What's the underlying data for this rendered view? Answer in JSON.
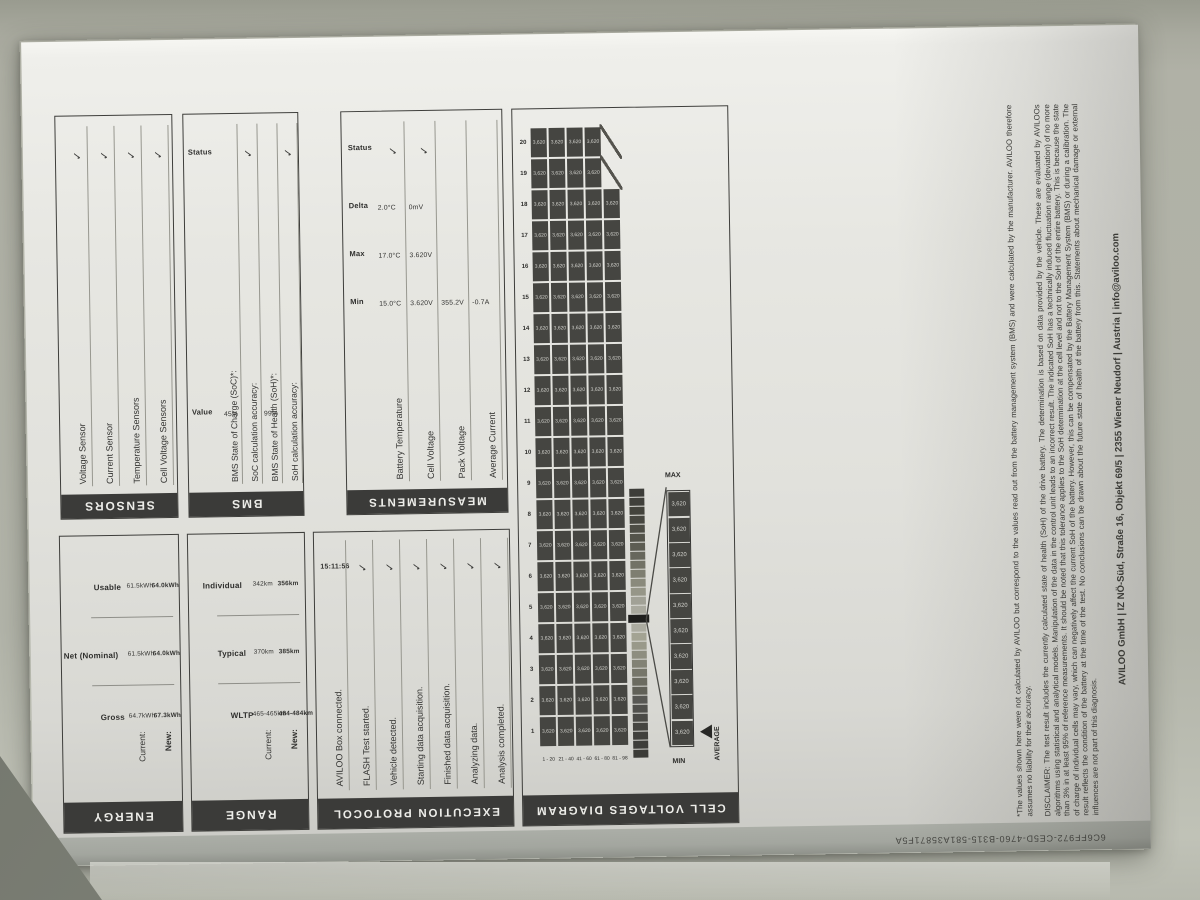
{
  "report": {
    "sections": {
      "sensors": {
        "title": "SENSORS",
        "rows": [
          {
            "label": "Voltage Sensor",
            "status": "✓"
          },
          {
            "label": "Current Sensor",
            "status": "✓"
          },
          {
            "label": "Temperature Sensors",
            "status": "✓"
          },
          {
            "label": "Cell Voltage Sensors",
            "status": "✓"
          }
        ]
      },
      "bms": {
        "title": "BMS",
        "headers": {
          "value": "Value",
          "status": "Status"
        },
        "rows": [
          {
            "label": "BMS State of Charge (SoC)*:",
            "value": "45%",
            "status": ""
          },
          {
            "label": "SoC calculation accuracy:",
            "value": "",
            "status": "✓"
          },
          {
            "label": "BMS State of Health (SoH)*:",
            "value": "99%",
            "status": ""
          },
          {
            "label": "SoH calculation accuracy:",
            "value": "",
            "status": "✓"
          }
        ]
      },
      "measurements": {
        "title": "MEASUREMENTS",
        "headers": {
          "min": "Min",
          "max": "Max",
          "delta": "Delta",
          "status": "Status"
        },
        "rows": [
          {
            "label": "Battery Temperature",
            "min": "15.0°C",
            "max": "17.0°C",
            "delta": "2.0°C",
            "status": "✓"
          },
          {
            "label": "Cell Voltage",
            "min": "3.620V",
            "max": "3.620V",
            "delta": "0mV",
            "status": "✓"
          },
          {
            "label": "Pack Voltage",
            "min": "355.2V",
            "max": "",
            "delta": "",
            "status": ""
          },
          {
            "label": "Average Current",
            "min": "-0.7A",
            "max": "",
            "delta": "",
            "status": ""
          }
        ]
      },
      "energy": {
        "title": "ENERGY",
        "cols": [
          "Gross",
          "Net (Nominal)",
          "Usable"
        ],
        "rows": [
          {
            "label": "Current:",
            "values": [
              "64.7kWh",
              "61.5kWh",
              "61.5kWh"
            ]
          },
          {
            "label": "New:",
            "values": [
              "67.3kWh",
              "64.0kWh",
              "64.0kWh"
            ]
          }
        ]
      },
      "range": {
        "title": "RANGE",
        "cols": [
          "WLTP",
          "Typical",
          "Individual"
        ],
        "rows": [
          {
            "label": "Current:",
            "values": [
              "465-465km",
              "370km",
              "342km"
            ]
          },
          {
            "label": "New:",
            "values": [
              "484-484km",
              "385km",
              "356km"
            ]
          }
        ]
      },
      "execution": {
        "title": "EXECUTION PROTOCOL",
        "rows": [
          {
            "label": "AVILOO Box connected.",
            "time": "15:11:56",
            "status": ""
          },
          {
            "label": "FLASH Test started.",
            "time": "",
            "status": "✓"
          },
          {
            "label": "Vehicle detected.",
            "time": "",
            "status": "✓"
          },
          {
            "label": "Starting data acquisition.",
            "time": "",
            "status": "✓"
          },
          {
            "label": "Finished data acquisition.",
            "time": "",
            "status": "✓"
          },
          {
            "label": "Analyzing data.",
            "time": "",
            "status": "✓"
          },
          {
            "label": "Analysis completed.",
            "time": "",
            "status": "✓"
          }
        ]
      },
      "cell_voltages": {
        "title": "CELL VOLTAGES DIAGRAM",
        "columns": [
          "1",
          "2",
          "3",
          "4",
          "5",
          "6",
          "7",
          "8",
          "9",
          "10",
          "11",
          "12",
          "13",
          "14",
          "15",
          "16",
          "17",
          "18",
          "19",
          "20"
        ],
        "cell_value": "3,620",
        "rows": [
          {
            "label": "1 - 20",
            "cells": 20
          },
          {
            "label": "21 - 40",
            "cells": 20
          },
          {
            "label": "41 - 60",
            "cells": 20
          },
          {
            "label": "61 - 80",
            "cells": 20
          },
          {
            "label": "81 - 98",
            "cells": 18
          }
        ],
        "scale": {
          "min_label": "MIN",
          "max_label": "MAX",
          "avg_label": "AVERAGE",
          "marker_index": 15,
          "magnified_values": [
            "3,620",
            "3,620",
            "3,620",
            "3,620",
            "3,620",
            "3,620",
            "3,620",
            "3,620",
            "3,620",
            "3,620"
          ],
          "colors": [
            "#3c3c38",
            "#3e3e3a",
            "#41413d",
            "#454541",
            "#4a4a46",
            "#50504c",
            "#585854",
            "#616158",
            "#6b6b60",
            "#76766a",
            "#828275",
            "#8e8e80",
            "#99998a",
            "#a3a393",
            "#ababa0",
            "#1f1f1d",
            "#a9a99e",
            "#a1a196",
            "#969688",
            "#8a8a7c",
            "#7e7e71",
            "#727266",
            "#67675c",
            "#5d5d53",
            "#54544b",
            "#4d4d45",
            "#474740",
            "#43433c",
            "#40403b",
            "#3d3d39"
          ]
        }
      }
    },
    "footnote": "*The values shown here were not calculated by AVILOO but correspond to the values read out from the battery management system (BMS) and were calculated by the manufacturer. AVILOO therefore assumes no liability for their accuracy.",
    "disclaimer": "DISCLAIMER: The test result includes the currently calculated state of health (SoH) of the drive battery. The determination is based on data provided by the vehicle. These are evaluated by AVILOOs algorithms using statistical and analytical models. Manipulation of the data in the control unit leads to an incorrect result. The indicated SoH has a technically induced fluctuation range (deviation) of no more than 3% in at least 95% of reference measurements. It should be noted that this tolerance applies to the SoH determination at the cell level and not to the SoH of the entire battery. This is because the state of charge of individual cells may vary, which can negatively affect the current SoH of the battery. However, this can be compensated by the Battery Management System (BMS) or during a calibration. The result reflects the condition of the battery at the time of the test. No conclusions can be drawn about the future state of health of the battery from this. Statements about mechanical damage or external influences are not part of this diagnosis.",
    "address": "AVILOO GmbH  |  IZ NÖ-Süd, Straße 16, Objekt 69/5  |  2355 Wiener Neudorf  |  Austria  |  info@aviloo.com",
    "document_id": "6C6FF972-CE5D-4760-B315-581A35871F5A"
  },
  "colors": {
    "paper": "#e4e4df",
    "desk": "#b0b1a6",
    "bar_dark": "#3b3b39",
    "cell_dark": "#454541",
    "cell_text": "#d4d4cf"
  }
}
